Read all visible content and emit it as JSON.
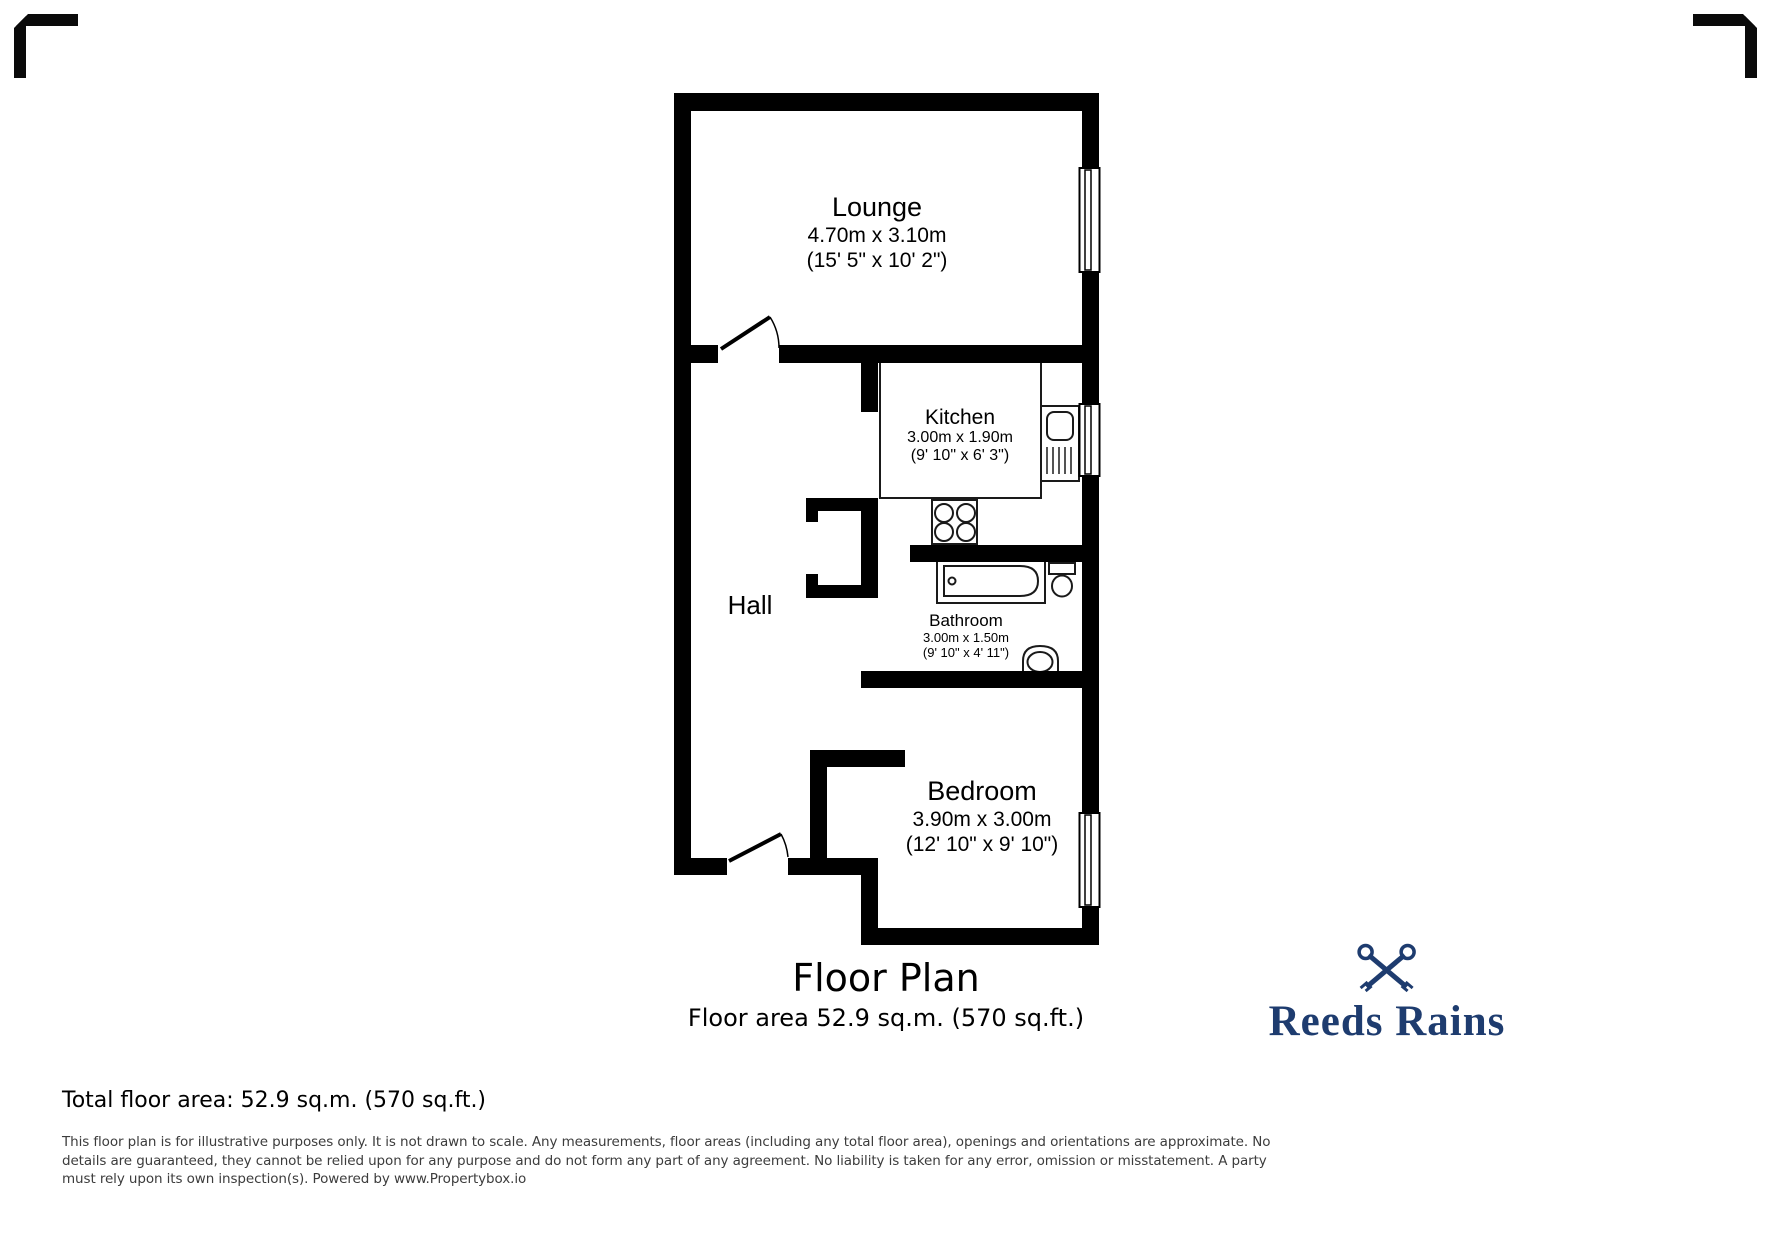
{
  "colors": {
    "wall": "#000000",
    "logo_navy": "#1e3c6f",
    "disclaimer_gray": "#3c3c3c"
  },
  "plan": {
    "rooms": [
      {
        "name": "Lounge",
        "dims_metric": "4.70m x 3.10m",
        "dims_imperial": "(15' 5\" x 10' 2\")"
      },
      {
        "name": "Kitchen",
        "dims_metric": "3.00m x 1.90m",
        "dims_imperial": "(9' 10\" x 6' 3\")"
      },
      {
        "name": "Hall"
      },
      {
        "name": "Bathroom",
        "dims_metric": "3.00m x 1.50m",
        "dims_imperial": "(9' 10\" x 4' 11\")"
      },
      {
        "name": "Bedroom",
        "dims_metric": "3.90m x 3.00m",
        "dims_imperial": "(12' 10\" x 9' 10\")"
      }
    ],
    "fixtures": [
      "bath",
      "toilet",
      "wash-basin",
      "sink-drainer-unit",
      "hob",
      "window-symbol",
      "door-swing"
    ]
  },
  "title": {
    "heading": "Floor Plan",
    "subheading": "Floor area 52.9 sq.m. (570 sq.ft.)"
  },
  "footer": {
    "total_area": "Total floor area: 52.9 sq.m. (570 sq.ft.)",
    "disclaimer_lines": [
      "This floor plan is for illustrative purposes only. It is not drawn to scale. Any measurements, floor areas (including any total floor area), openings and orientations are approximate. No",
      "details are guaranteed, they cannot be relied upon for any purpose and do not form any part of any agreement. No liability is taken for any error, omission or misstatement. A party",
      "must rely upon its own inspection(s). Powered by www.Propertybox.io"
    ]
  },
  "logo": {
    "brand": "Reeds Rains"
  }
}
